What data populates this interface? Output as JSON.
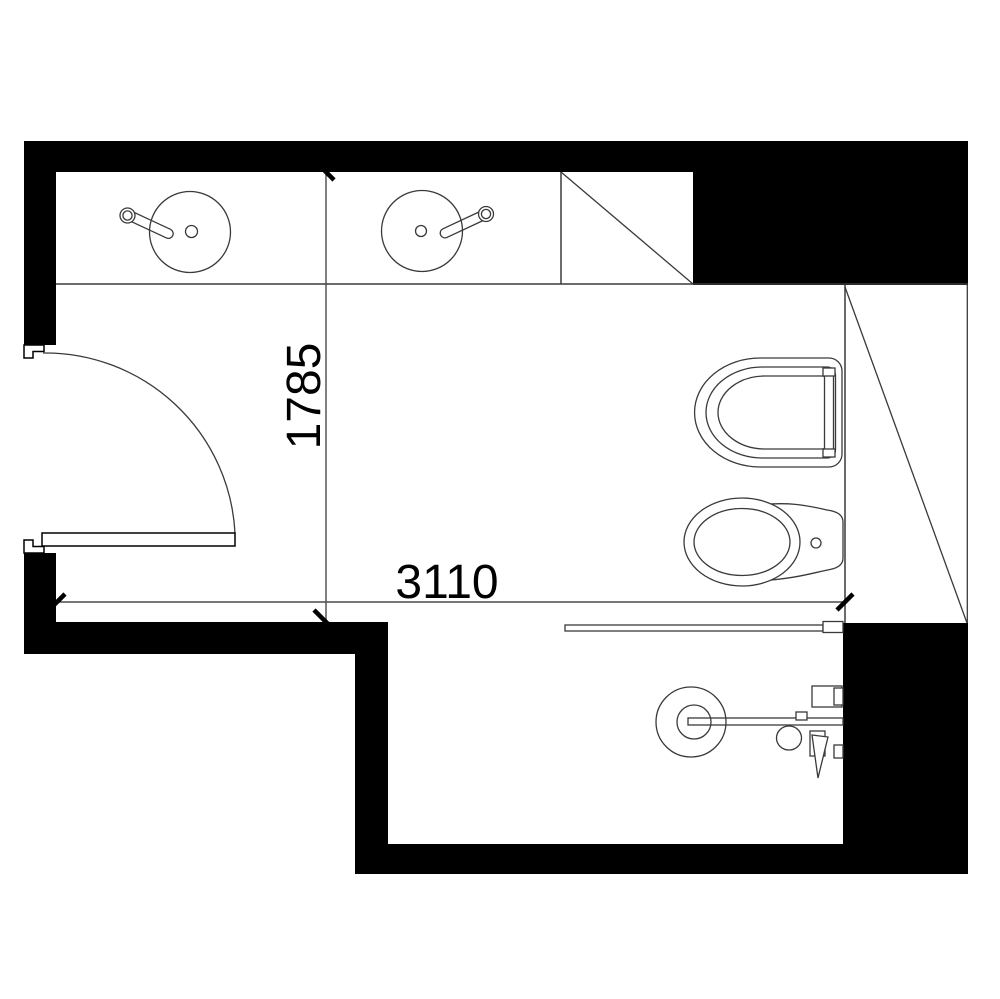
{
  "meta": {
    "title": "Bathroom floor plan"
  },
  "drawing": {
    "type": "architectural-floor-plan",
    "room": "bathroom",
    "dimensions": {
      "width_label": "3110",
      "height_label": "1785"
    },
    "fixtures": [
      "entry-door",
      "vanity-counter",
      "sink-left",
      "sink-right",
      "cabinet-with-diagonal",
      "wall-hung-toilet",
      "bidet",
      "shower-glass-panel",
      "shower-mixer",
      "hand-shower",
      "sloped-ceiling-zone"
    ],
    "colors": {
      "walls": "#000000",
      "lines": "#3a3a3a",
      "dimension_lines": "#4a4a4a",
      "text": "#000000",
      "background": "#ffffff"
    }
  }
}
